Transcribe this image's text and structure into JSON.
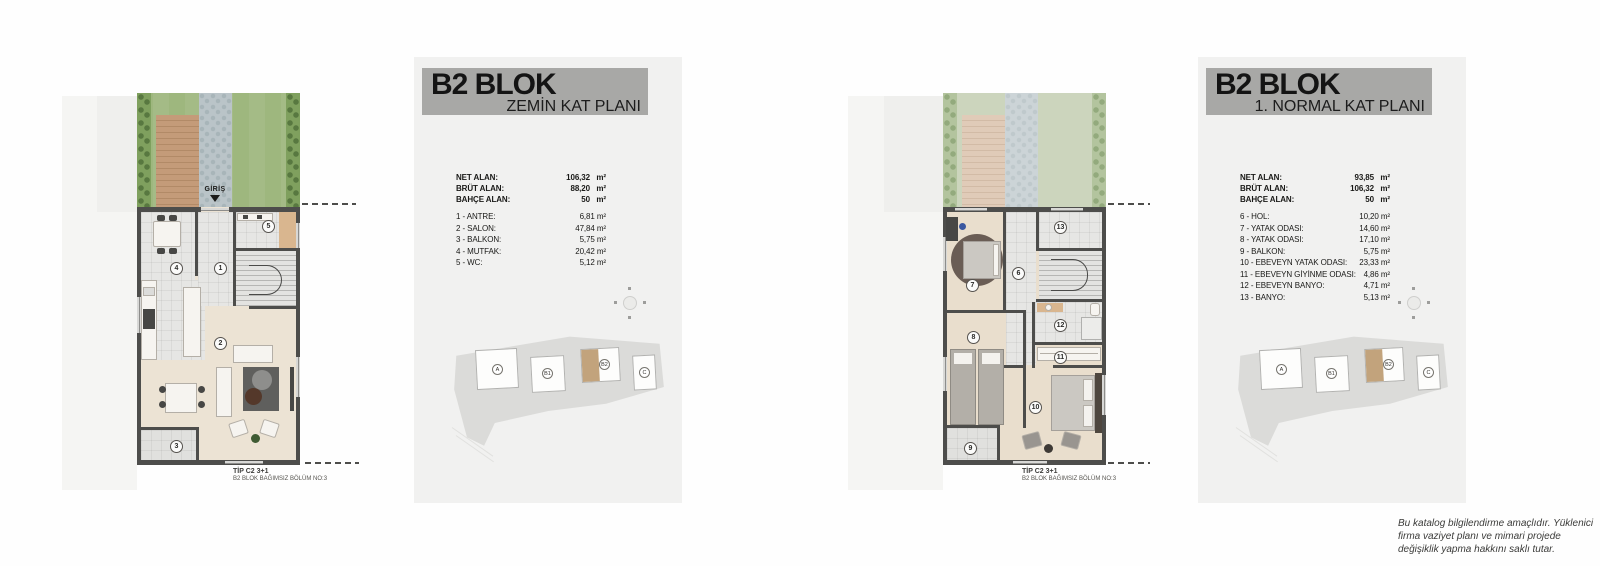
{
  "colors": {
    "page_bg": "#fefefe",
    "panel_bg": "#f1f1f0",
    "header_bg": "#a8a8a6",
    "wall": "#4d4d4b",
    "lawn_green": "#9eb77e",
    "deck_wood": "#c49b79",
    "stone_path": "#bac4c8",
    "salon_floor": "#ece3d4",
    "tile_floor": "#e6e6e4",
    "block_highlight": "#c2a37c"
  },
  "ground": {
    "title": "B2 BLOK",
    "subtitle": "ZEMİN KAT PLANI",
    "entrance_label": "GİRİŞ",
    "type_label": "TİP C2 3+1",
    "unit_label": "B2 BLOK BAĞIMSIZ BÖLÜM NO:3",
    "room_numbers": [
      "1",
      "2",
      "3",
      "4",
      "5"
    ],
    "summary": [
      {
        "label": "NET ALAN:",
        "value": "106,32",
        "unit": "m²"
      },
      {
        "label": "BRÜT ALAN:",
        "value": "88,20",
        "unit": "m²"
      },
      {
        "label": "BAHÇE ALAN:",
        "value": "50",
        "unit": "m²"
      }
    ],
    "rooms": [
      {
        "label": "1 - ANTRE:",
        "value": "6,81 m²"
      },
      {
        "label": "2 - SALON:",
        "value": "47,84 m²"
      },
      {
        "label": "3 - BALKON:",
        "value": "5,75 m²"
      },
      {
        "label": "4 - MUTFAK:",
        "value": "20,42 m²"
      },
      {
        "label": "5 - WC:",
        "value": "5,12 m²"
      }
    ]
  },
  "first": {
    "title": "B2 BLOK",
    "subtitle": "1. NORMAL KAT PLANI",
    "type_label": "TİP C2 3+1",
    "unit_label": "B2 BLOK BAĞIMSIZ BÖLÜM NO:3",
    "room_numbers": [
      "6",
      "7",
      "8",
      "9",
      "10",
      "11",
      "12",
      "13"
    ],
    "summary": [
      {
        "label": "NET ALAN:",
        "value": "93,85",
        "unit": "m²"
      },
      {
        "label": "BRÜT ALAN:",
        "value": "106,32",
        "unit": "m²"
      },
      {
        "label": "BAHÇE ALAN:",
        "value": "50",
        "unit": "m²"
      }
    ],
    "rooms": [
      {
        "label": "6 - HOL:",
        "value": "10,20 m²"
      },
      {
        "label": "7 - YATAK ODASI:",
        "value": "14,60 m²"
      },
      {
        "label": "8 - YATAK ODASI:",
        "value": "17,10 m²"
      },
      {
        "label": "9 - BALKON:",
        "value": "5,75 m²"
      },
      {
        "label": "10 - EBEVEYN YATAK ODASI:",
        "value": "23,33 m²"
      },
      {
        "label": "11 - EBEVEYN GİYİNME ODASI:",
        "value": "4,86 m²"
      },
      {
        "label": "12 - EBEVEYN BANYO:",
        "value": "4,71 m²"
      },
      {
        "label": "13 - BANYO:",
        "value": "5,13 m²"
      }
    ]
  },
  "siteplan": {
    "blocks": [
      "A",
      "B1",
      "B2",
      "C"
    ],
    "highlighted_block": "B2"
  },
  "disclaimer": "Bu katalog bilgilendirme amaçlıdır. Yüklenici firma vaziyet planı ve mimari projede değişiklik yapma hakkını saklı tutar."
}
